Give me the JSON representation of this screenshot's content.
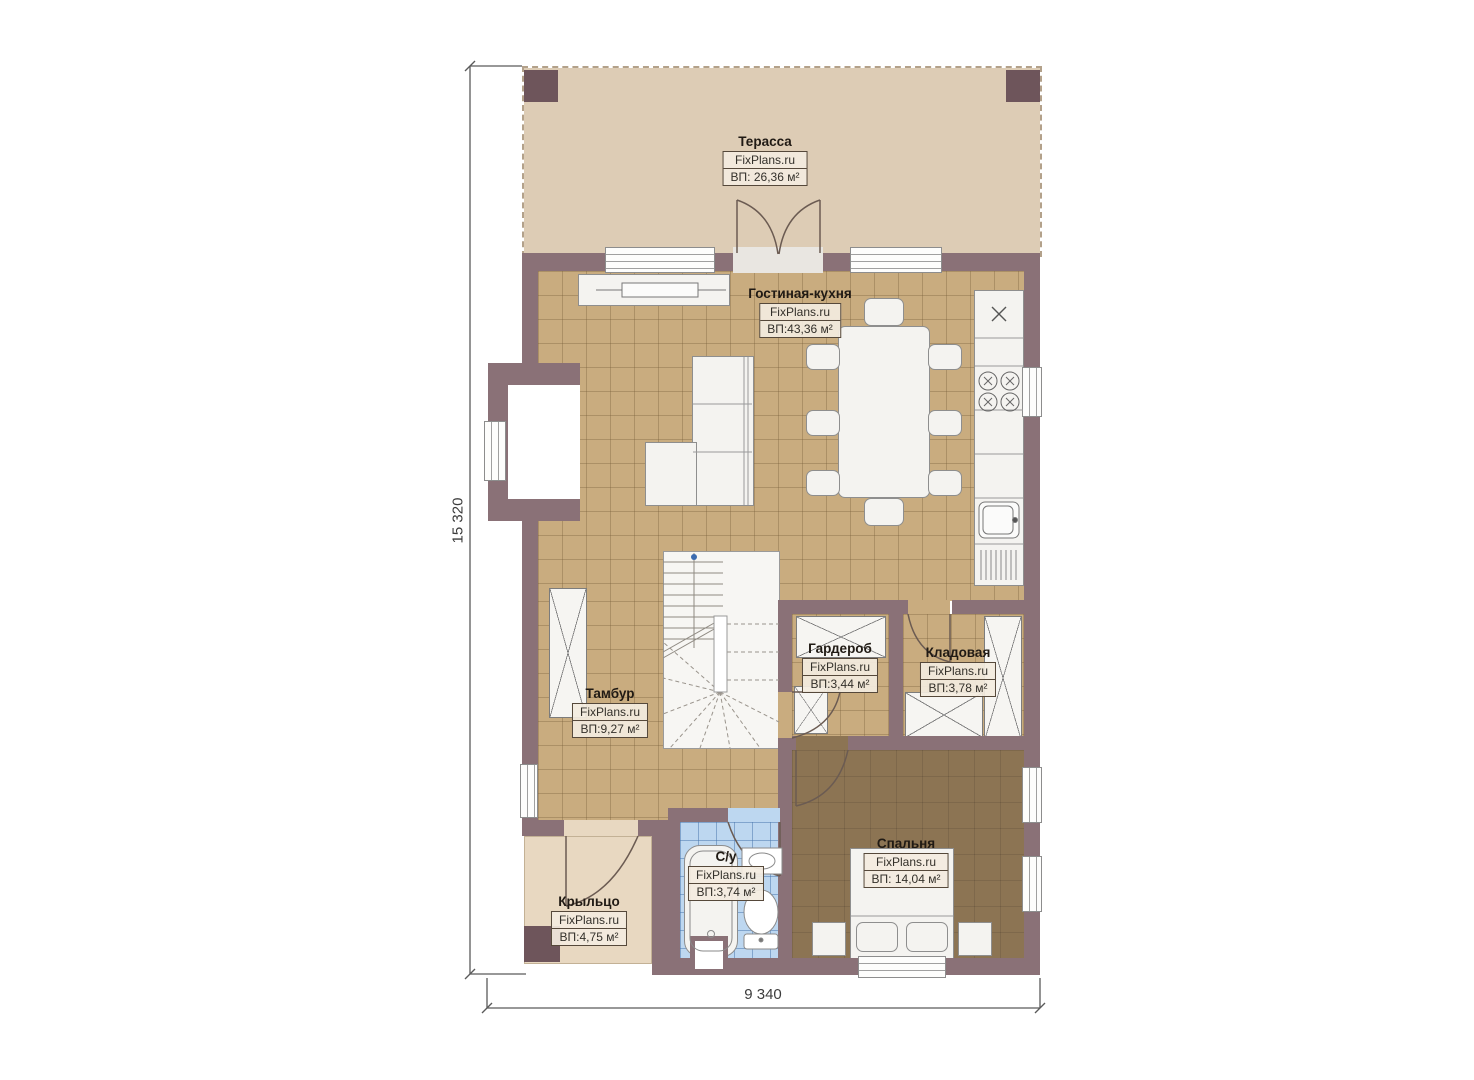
{
  "plan": {
    "type": "floor-plan",
    "floor_dimensions": {
      "vertical": "15 320",
      "horizontal": "9 340"
    }
  },
  "watermark": "FixPlans.ru",
  "rooms": [
    {
      "id": "terrace",
      "name": "Терасса",
      "area": "ВП: 26,36 м²"
    },
    {
      "id": "living-kitchen",
      "name": "Гостиная-кухня",
      "area": "ВП:43,36 м²"
    },
    {
      "id": "tambour",
      "name": "Тамбур",
      "area": "ВП:9,27 м²"
    },
    {
      "id": "wardrobe",
      "name": "Гардероб",
      "area": "ВП:3,44 м²"
    },
    {
      "id": "storage",
      "name": "Кладовая",
      "area": "ВП:3,78 м²"
    },
    {
      "id": "bathroom",
      "name": "С/у",
      "area": "ВП:3,74 м²"
    },
    {
      "id": "bedroom",
      "name": "Спальня",
      "area": "ВП: 14,04 м²"
    },
    {
      "id": "porch",
      "name": "Крыльцо",
      "area": "ВП:4,75 м²"
    }
  ],
  "colors": {
    "wall": "#8a7177",
    "post": "#6e555b",
    "terrace_floor": "#ddccb5",
    "tile_floor": "#c9ac7f",
    "bedroom_floor": "#8c7453",
    "bathroom_floor": "#bdd7f0",
    "porch_floor": "#e8d8c1"
  }
}
